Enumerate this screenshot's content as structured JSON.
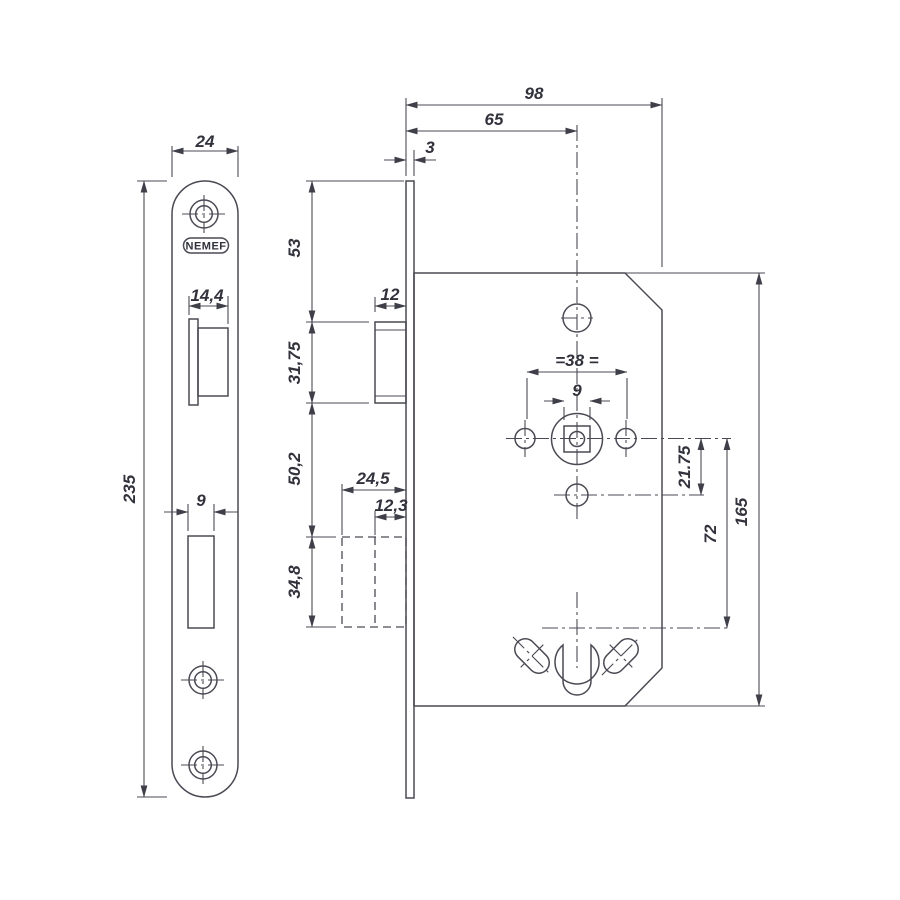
{
  "palette": {
    "line_color": "#4a4a54",
    "text_color": "#32323c",
    "background": "#ffffff"
  },
  "front_view": {
    "brand": "NEMEF",
    "plate_width": "24",
    "plate_height": "235",
    "latch_width": "14,4",
    "bolt_cutout_width": "9"
  },
  "side_view": {
    "case_depth": "98",
    "backset": "65",
    "faceplate_thickness": "3",
    "top_to_latch": "53",
    "latch_protrusion": "12",
    "latch_height": "31,75",
    "latch_to_bolt": "50,2",
    "bolt_depth": "24,5",
    "bolt_throw": "12,3",
    "bolt_height": "34,8",
    "spindle_holes_spacing": "=38 =",
    "spindle_square": "9",
    "spindle_to_lower_hole": "21.75",
    "spindle_to_cylinder": "72",
    "case_height": "165"
  }
}
